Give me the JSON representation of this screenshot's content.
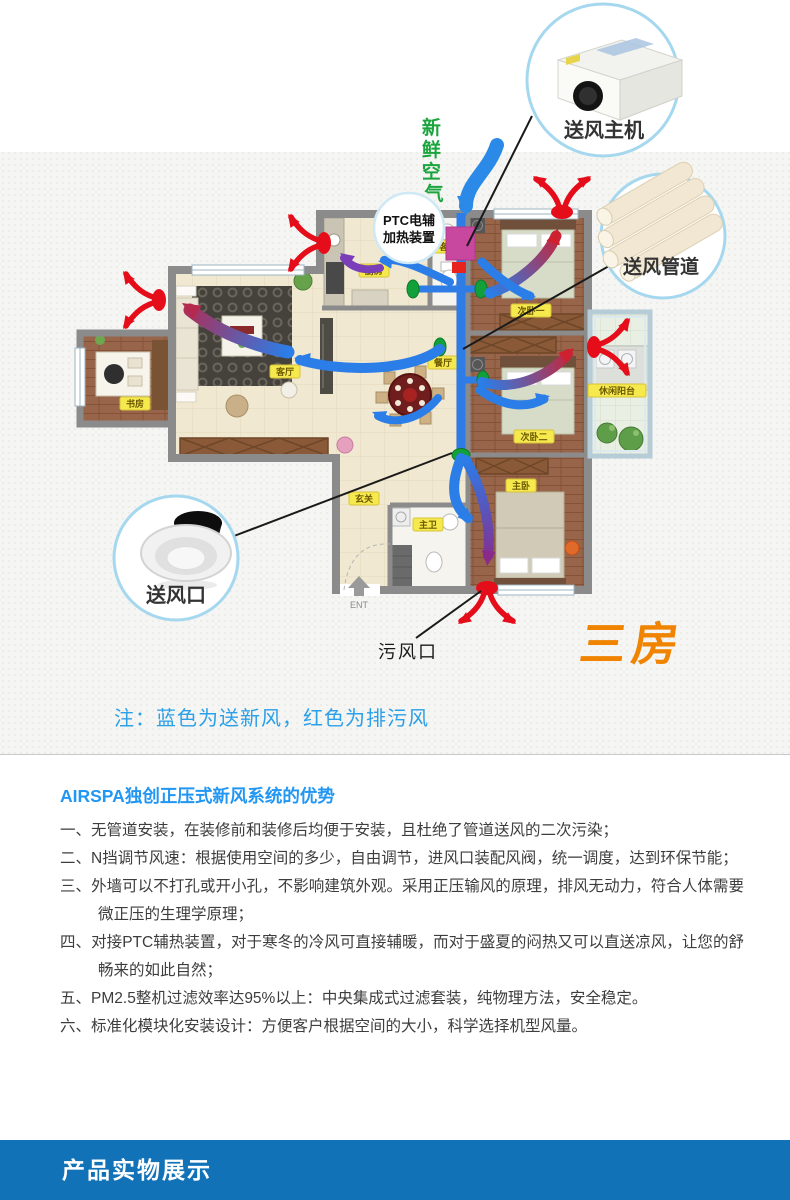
{
  "diagram": {
    "fresh_air": {
      "c1": "新",
      "c2": "鲜",
      "c3": "空",
      "c4": "气"
    },
    "ptc": {
      "line1": "PTC电辅",
      "line2": "加热装置"
    },
    "callouts": {
      "main_unit": "送风主机",
      "duct_pipes": "送风管道",
      "supply_outlet": "送风口"
    },
    "exhaust_outlet_label": "污风口",
    "layout_badge": "三房",
    "entrance_label": "ENT",
    "rooms": {
      "study": "书房",
      "kitchen": "厨房",
      "living": "客厅",
      "dining": "餐厅",
      "bedroom1": "次卧一",
      "bedroom2": "次卧二",
      "master": "主卧",
      "master_bath": "主卫",
      "guest_bath": "客卫",
      "foyer": "玄关",
      "balcony": "休闲阳台"
    },
    "note": "注：蓝色为送新风，红色为排污风",
    "colors": {
      "supply_blue": "#2b7de8",
      "exhaust_red": "#e60d1a",
      "fresh_green": "#1ca53e",
      "badge_orange": "#f08300",
      "note_blue": "#2b9fe8",
      "callout_ring": "#a5d8ef",
      "ptc_box_pink": "#c9489f",
      "banner_blue": "#1272b8"
    }
  },
  "advantages": {
    "heading": "AIRSPA独创正压式新风系统的优势",
    "items": [
      {
        "marker": "一、",
        "text": "无管道安装，在装修前和装修后均便于安装，且杜绝了管道送风的二次污染；"
      },
      {
        "marker": "二、",
        "text": "N挡调节风速：根据使用空间的多少，自由调节，进风口装配风阀，统一调度，达到环保节能；"
      },
      {
        "marker": "三、",
        "text": "外墙可以不打孔或开小孔，不影响建筑外观。采用正压输风的原理，排风无动力，符合人体需要微正压的生理学原理；"
      },
      {
        "marker": "四、",
        "text": "对接PTC辅热装置，对于寒冬的冷风可直接辅暖，而对于盛夏的闷热又可以直送凉风，让您的舒畅来的如此自然；"
      },
      {
        "marker": "五、",
        "text": "PM2.5整机过滤效率达95%以上：中央集成式过滤套装，纯物理方法，安全稳定。"
      },
      {
        "marker": "六、",
        "text": "标准化模块化安装设计：方便客户根据空间的大小，科学选择机型风量。"
      }
    ]
  },
  "footer": {
    "banner": "产品实物展示"
  }
}
